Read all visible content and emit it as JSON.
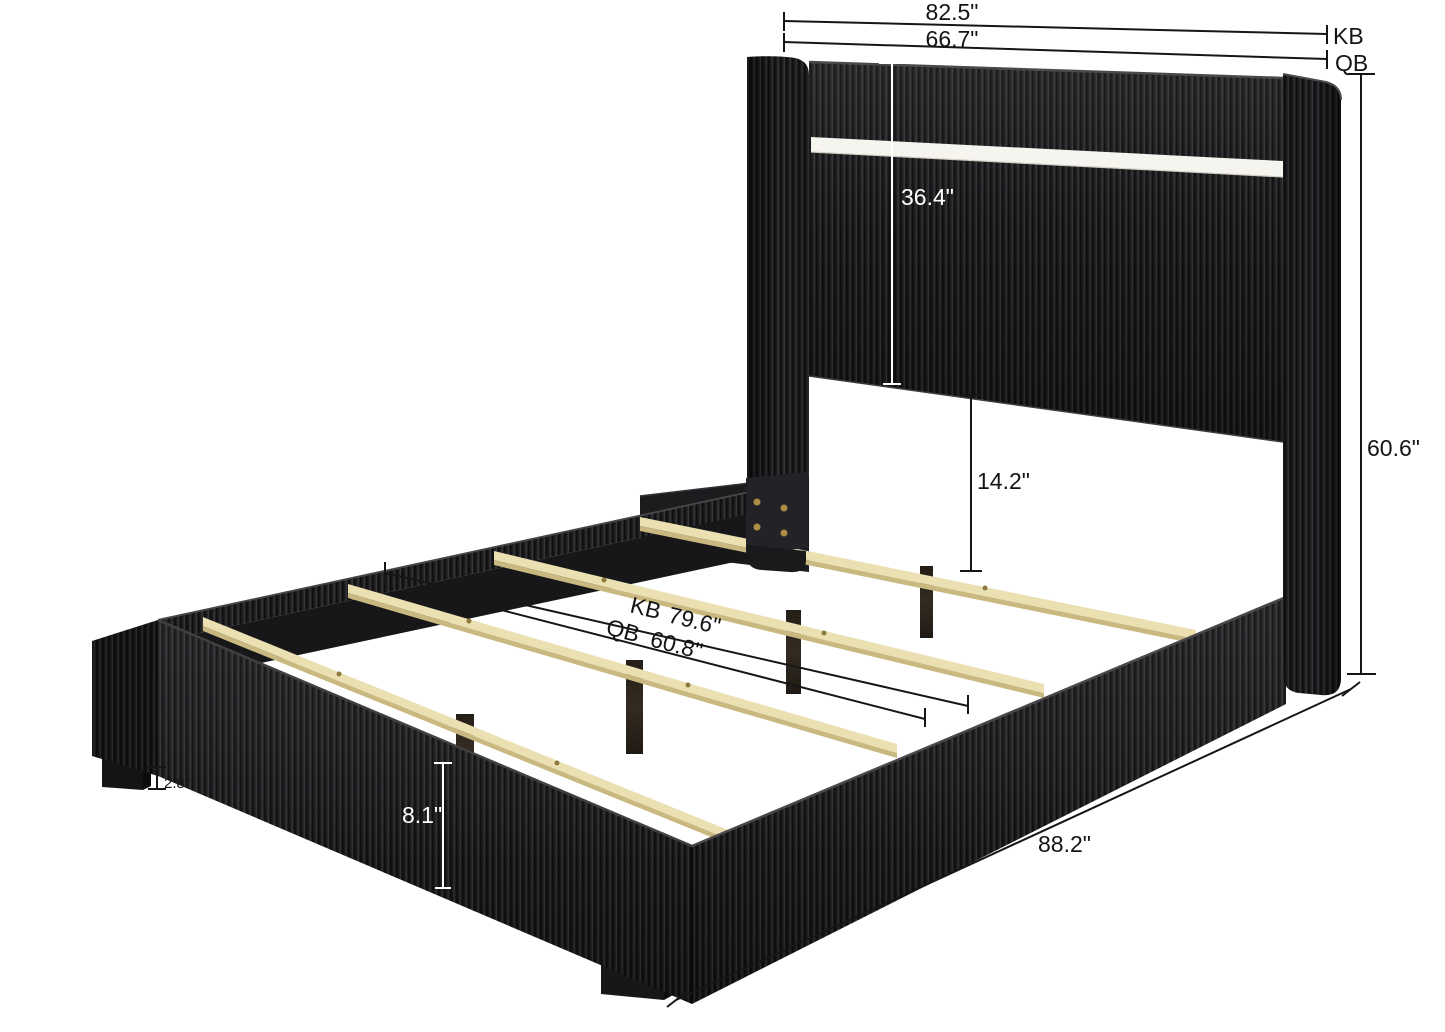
{
  "page": {
    "description": "Product dimension diagram of a black corduroy upholstered platform bed with wingback LED headboard, pine wood slats, center support legs and block feet",
    "background": "#ffffff"
  },
  "palette": {
    "fabric": "#1d1d1f",
    "fabric_rib_highlight": "#39393c",
    "fabric_rib_shadow": "#0f0f11",
    "led_strip": "#f6f4ee",
    "slat_wood": "#eae0b2",
    "slat_edge": "#c9b981",
    "inner_rail_wood": "#17171a",
    "center_leg_wood": "#2b241c",
    "screw_brass": "#ad8c45",
    "dimension_line": "#161616",
    "dimension_line_light": "#ffffff"
  },
  "annotations": {
    "top_width_king": {
      "value": "82.5\"",
      "tag": "KB"
    },
    "top_width_queen": {
      "value": "66.7\"",
      "tag": "QB"
    },
    "headboard_panel_height": {
      "value": "36.4\""
    },
    "overall_height": {
      "value": "60.6\""
    },
    "headboard_to_slat_clearance": {
      "value": "14.2\""
    },
    "interior_length_king": {
      "tag": "KB",
      "value": "79.6\""
    },
    "interior_length_queen": {
      "tag": "QB",
      "value": "60.8\""
    },
    "rail_height": {
      "value": "8.1\""
    },
    "foot_leg_height": {
      "value": "2.8\""
    },
    "overall_length": {
      "value": "88.2\""
    }
  }
}
